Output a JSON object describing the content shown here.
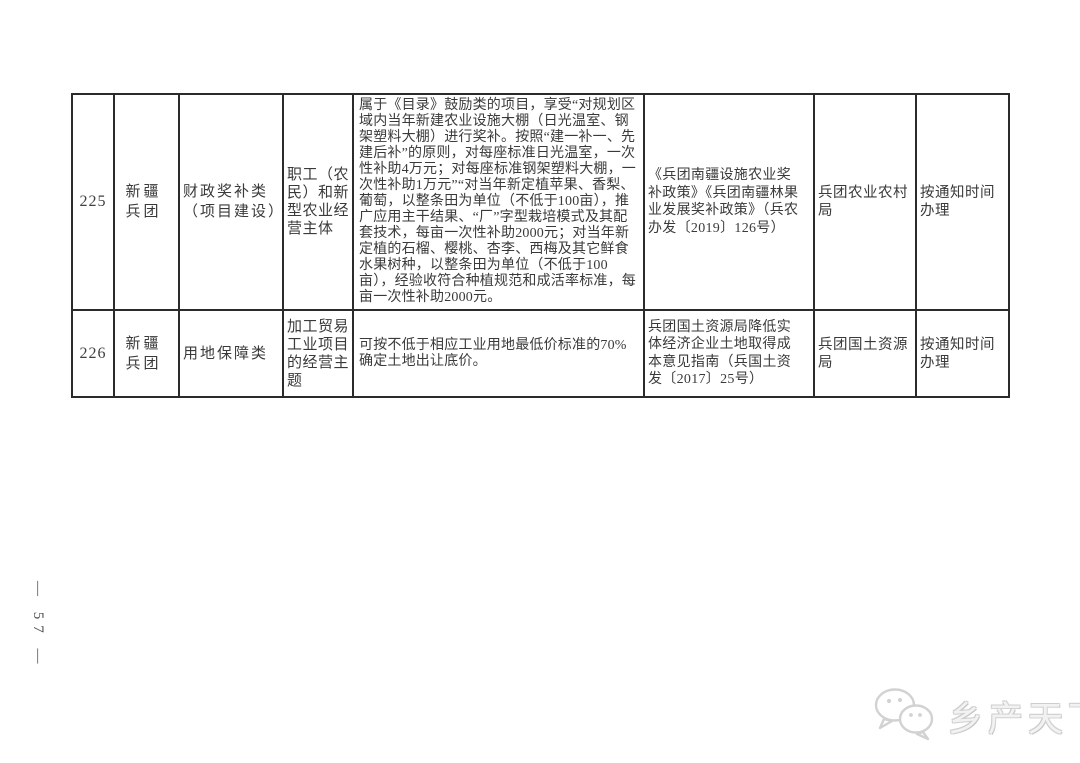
{
  "page": {
    "page_number": "— 57 —"
  },
  "colors": {
    "table_border": "#2b2b2b",
    "body_text": "#3a3a3a",
    "watermark_gray": "#cfcfcf"
  },
  "table": {
    "rows": [
      {
        "id": "225",
        "region": "新疆兵团",
        "category": "财政奖补类（项目建设）",
        "beneficiary": "职工（农民）和新型农业经营主体",
        "policy": "属于《目录》鼓励类的项目，享受“对规划区域内当年新建农业设施大棚（日光温室、钢架塑料大棚）进行奖补。按照“建一补一、先建后补”的原则，对每座标准日光温室，一次性补助4万元；对每座标准钢架塑料大棚，一次性补助1万元”“对当年新定植苹果、香梨、葡萄，以整条田为单位（不低于100亩），推广应用主干结果、“厂”字型栽培模式及其配套技术，每亩一次性补助2000元；对当年新定植的石榴、樱桃、杏李、西梅及其它鲜食水果树种，以整条田为单位（不低于100亩），经验收符合种植规范和成活率标准，每亩一次性补助2000元。",
        "document": "《兵团南疆设施农业奖补政策》《兵团南疆林果业发展奖补政策》（兵农办发〔2019〕126号）",
        "department": "兵团农业农村局",
        "schedule": "按通知时间办理"
      },
      {
        "id": "226",
        "region": "新疆兵团",
        "category": "用地保障类",
        "beneficiary": "加工贸易工业项目的经营主题",
        "policy": "可按不低于相应工业用地最低价标准的70%确定土地出让底价。",
        "document": "兵团国土资源局降低实体经济企业土地取得成本意见指南（兵国土资发〔2017〕25号）",
        "department": "兵团国土资源局",
        "schedule": "按通知时间办理"
      }
    ]
  },
  "watermark": {
    "brand": "乡产天下",
    "icon": "wechat-chat-bubbles-icon"
  }
}
